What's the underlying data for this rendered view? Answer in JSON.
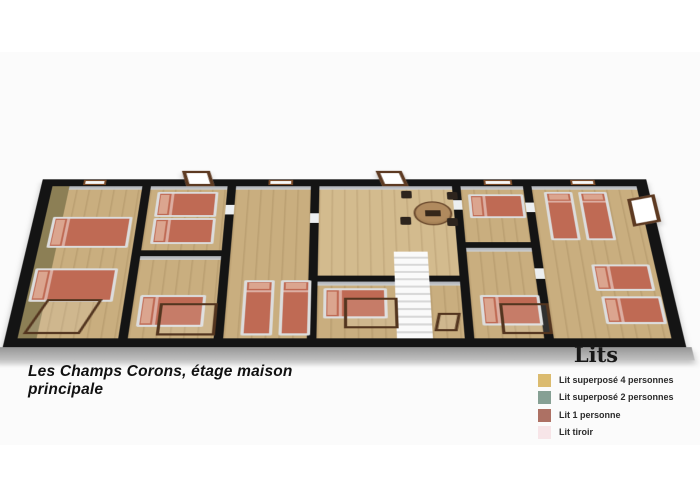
{
  "page": {
    "background": "#ffffff",
    "band_color": "#fbfbfb"
  },
  "caption": {
    "text": "Les Champs Corons, étage maison principale"
  },
  "legend": {
    "title": "Lits",
    "items": [
      {
        "label": "Lit superposé 4 personnes",
        "color": "#dbbb6f"
      },
      {
        "label": "Lit superposé 2 personnes",
        "color": "#86a094"
      },
      {
        "label": "Lit 1 personne",
        "color": "#ad7164"
      },
      {
        "label": "Lit tiroir",
        "color": "#f7e5e8"
      }
    ]
  },
  "floorplan": {
    "colors": {
      "outer_wall": "#141414",
      "floor_wood": "#c9ae7f",
      "floor_light": "#d3bb8e",
      "accent_wall_olive": "#8c7f55",
      "bed": "#bf6a54",
      "bed_frame": "#dcdcdc",
      "pillow": "#dba58f",
      "wood_frame": "#53351f",
      "base": "#b0b0b0",
      "stairs": "#f2f2f2"
    },
    "rooms": [
      {
        "x": 12,
        "y": 12,
        "w": 95,
        "h": 236,
        "v": "accent"
      },
      {
        "x": 116,
        "y": 12,
        "w": 81,
        "h": 106
      },
      {
        "x": 116,
        "y": 127,
        "w": 81,
        "h": 121
      },
      {
        "x": 206,
        "y": 12,
        "w": 79,
        "h": 236
      },
      {
        "x": 294,
        "y": 12,
        "w": 140,
        "h": 145,
        "v": "light"
      },
      {
        "x": 294,
        "y": 166,
        "w": 76,
        "h": 82
      },
      {
        "x": 404,
        "y": 166,
        "w": 30,
        "h": 82
      },
      {
        "x": 443,
        "y": 12,
        "w": 66,
        "h": 93
      },
      {
        "x": 443,
        "y": 114,
        "w": 66,
        "h": 134
      },
      {
        "x": 518,
        "y": 12,
        "w": 111,
        "h": 236
      }
    ],
    "beds": [
      {
        "x": 20,
        "y": 64,
        "w": 82,
        "h": 50,
        "dir": "h"
      },
      {
        "x": 14,
        "y": 146,
        "w": 82,
        "h": 50,
        "dir": "h"
      },
      {
        "x": 124,
        "y": 22,
        "w": 64,
        "h": 42,
        "dir": "h"
      },
      {
        "x": 124,
        "y": 66,
        "w": 64,
        "h": 42,
        "dir": "h"
      },
      {
        "x": 122,
        "y": 186,
        "w": 64,
        "h": 46,
        "dir": "h"
      },
      {
        "x": 222,
        "y": 164,
        "w": 30,
        "h": 80,
        "dir": "v"
      },
      {
        "x": 258,
        "y": 164,
        "w": 30,
        "h": 80,
        "dir": "v"
      },
      {
        "x": 300,
        "y": 176,
        "w": 62,
        "h": 44,
        "dir": "h"
      },
      {
        "x": 450,
        "y": 26,
        "w": 58,
        "h": 40,
        "dir": "h"
      },
      {
        "x": 452,
        "y": 186,
        "w": 58,
        "h": 44,
        "dir": "h"
      },
      {
        "x": 530,
        "y": 22,
        "w": 30,
        "h": 80,
        "dir": "v"
      },
      {
        "x": 566,
        "y": 22,
        "w": 30,
        "h": 80,
        "dir": "v"
      },
      {
        "x": 566,
        "y": 140,
        "w": 58,
        "h": 40,
        "dir": "h"
      },
      {
        "x": 570,
        "y": 188,
        "w": 58,
        "h": 40,
        "dir": "h"
      }
    ],
    "bunk_frames": [
      {
        "x": 142,
        "y": 198,
        "w": 56,
        "h": 46,
        "skew": 0
      },
      {
        "x": 320,
        "y": 190,
        "w": 52,
        "h": 44,
        "skew": 0
      },
      {
        "x": 470,
        "y": 198,
        "w": 48,
        "h": 44,
        "skew": 0
      },
      {
        "x": 24,
        "y": 192,
        "w": 54,
        "h": 50,
        "skew": -18
      },
      {
        "x": 408,
        "y": 212,
        "w": 22,
        "h": 26,
        "skew": -10
      }
    ],
    "flat_windows": [
      {
        "x": 44,
        "w": 24
      },
      {
        "x": 240,
        "w": 26
      },
      {
        "x": 468,
        "w": 30
      },
      {
        "x": 560,
        "w": 26
      }
    ],
    "open_windows": [
      {
        "x": 150,
        "w": 30
      },
      {
        "x": 357,
        "w": 28
      }
    ],
    "jambs": [
      {
        "x": 197,
        "y": 44
      },
      {
        "x": 285,
        "y": 58
      },
      {
        "x": 434,
        "y": 36
      },
      {
        "x": 509,
        "y": 40
      },
      {
        "x": 509,
        "y": 146
      }
    ],
    "stairs": {
      "x": 370,
      "y": 120,
      "w": 34,
      "h": 128
    },
    "table": {
      "x": 392,
      "y": 38,
      "d": 40
    },
    "chairs": [
      {
        "x": 380,
        "y": 20
      },
      {
        "x": 428,
        "y": 22
      },
      {
        "x": 378,
        "y": 64
      },
      {
        "x": 426,
        "y": 66
      }
    ],
    "door_right": {
      "x": 616,
      "y": 30,
      "w": 30,
      "h": 46
    }
  }
}
